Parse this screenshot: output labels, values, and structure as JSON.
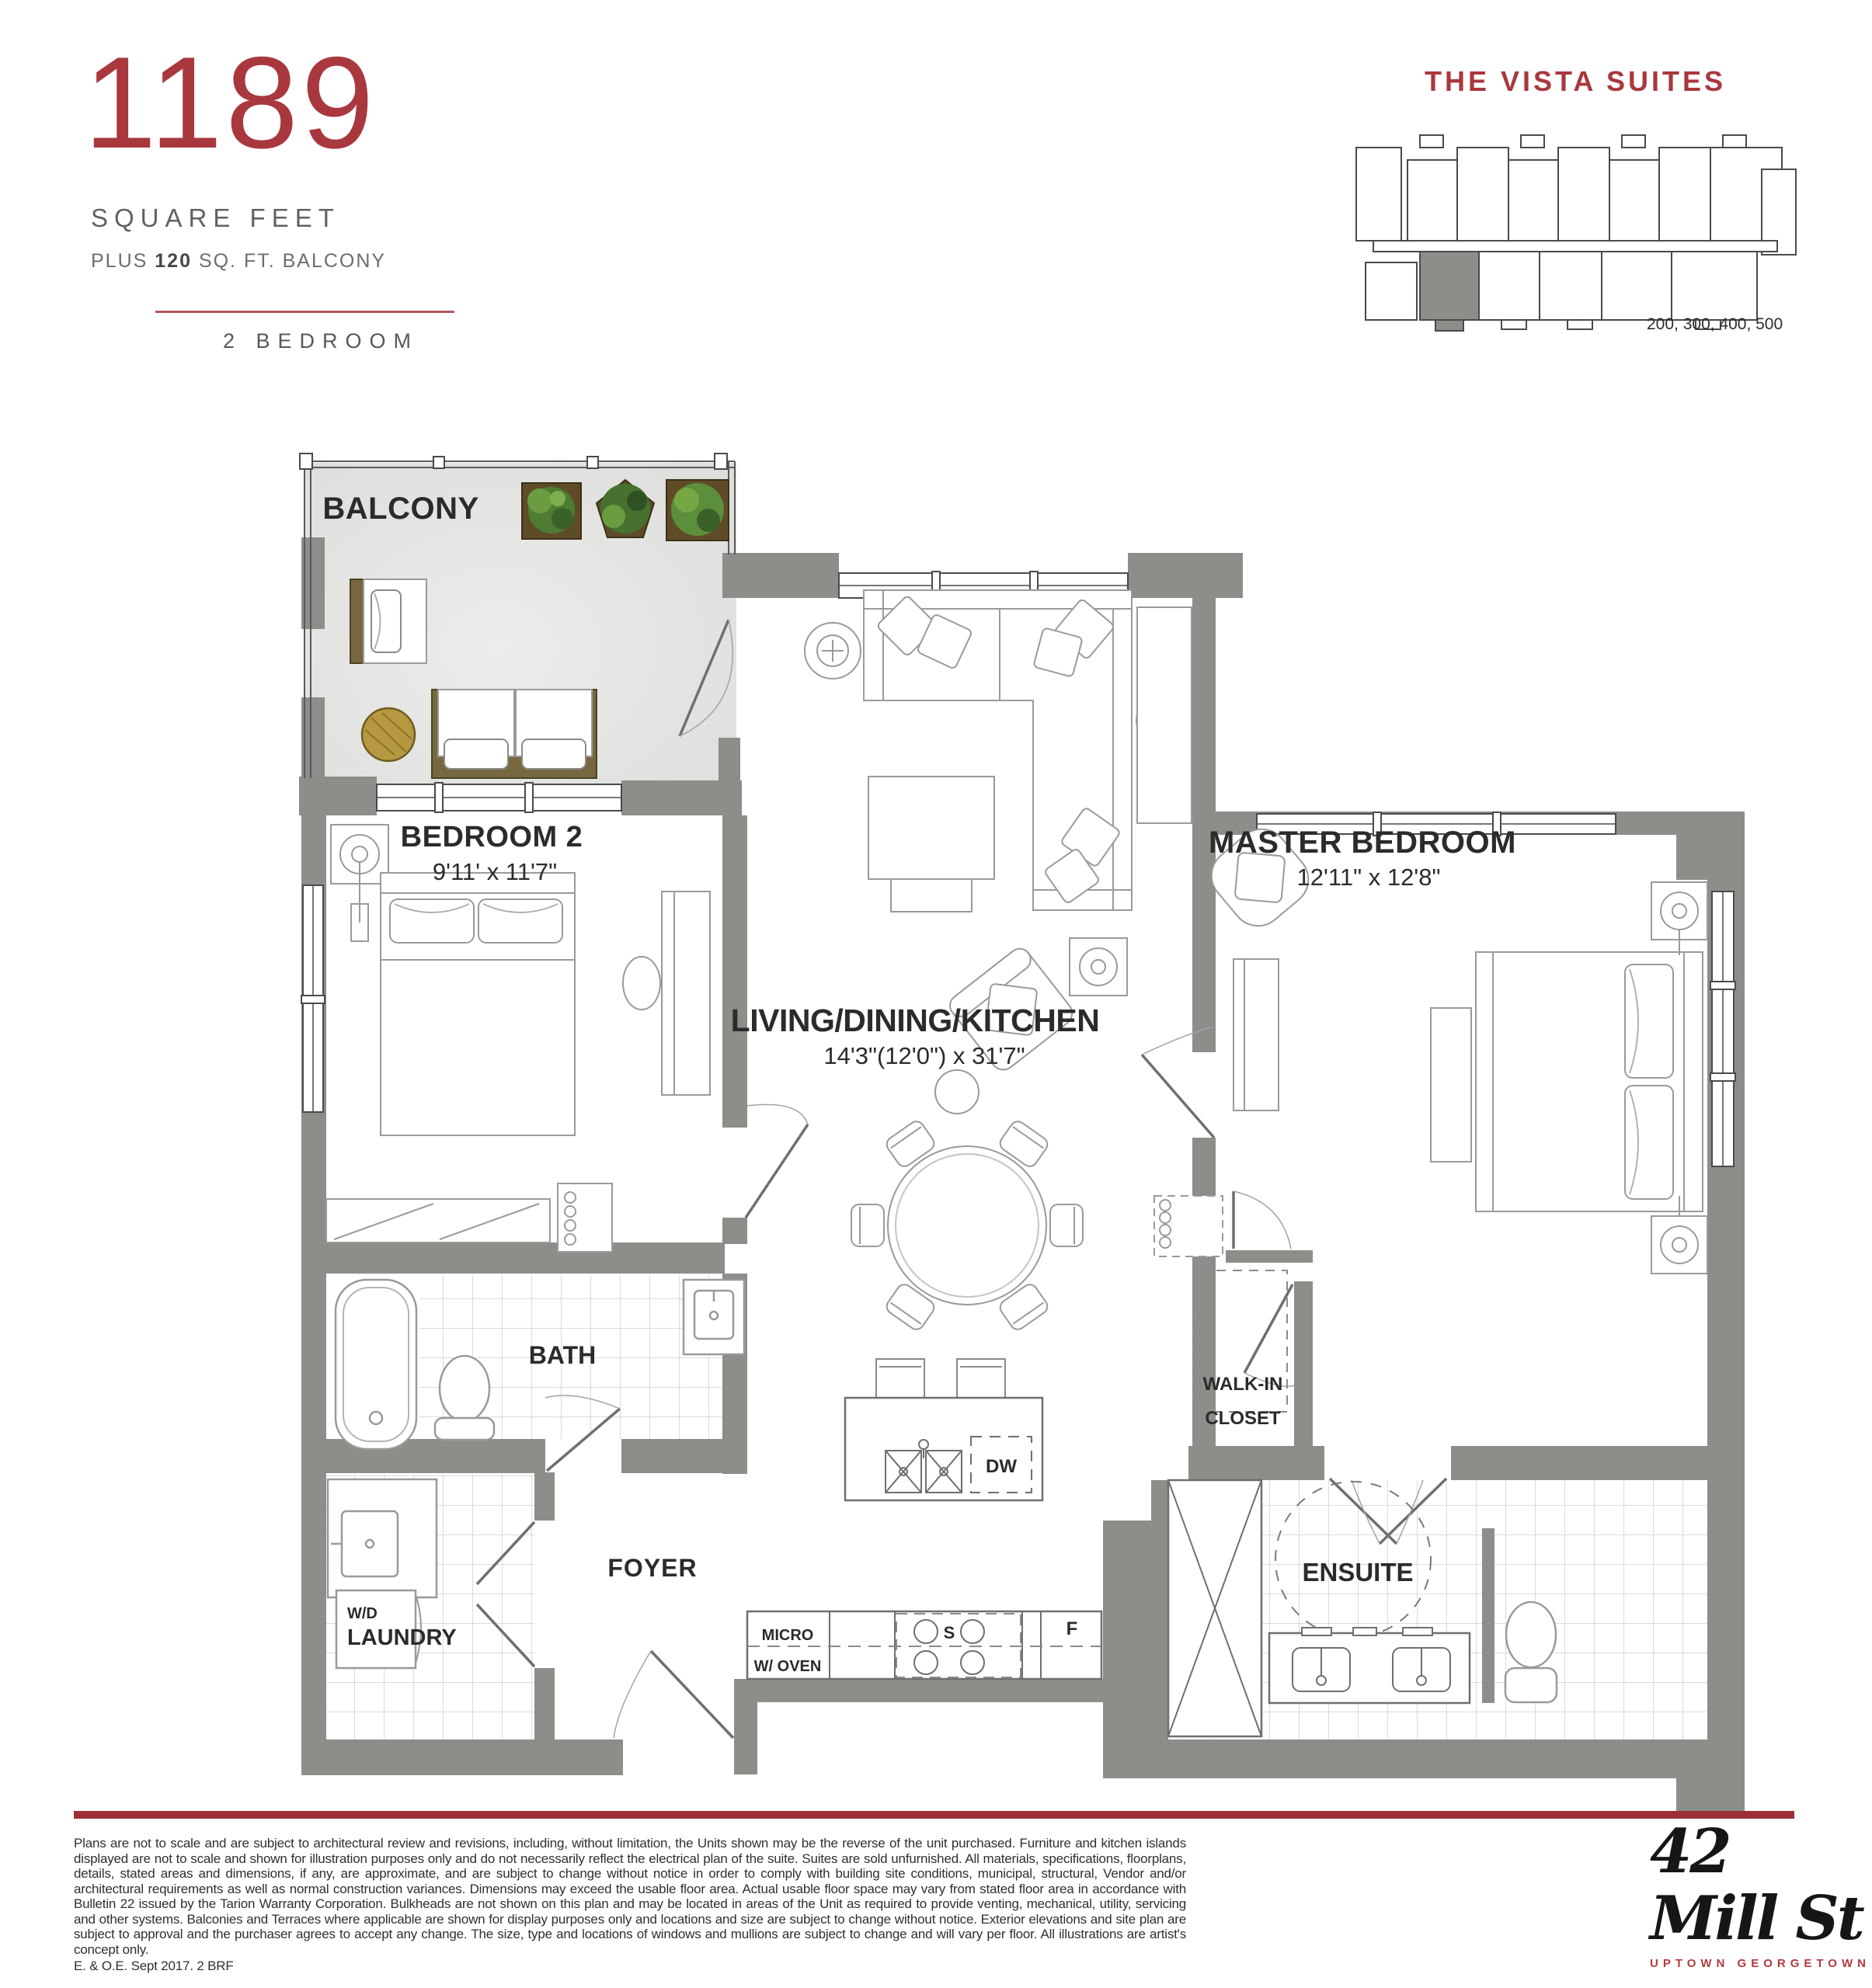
{
  "header": {
    "area_number": "1189",
    "area_label": "SQUARE FEET",
    "balcony_prefix": "PLUS",
    "balcony_bold": "120",
    "balcony_suffix": "SQ. FT. BALCONY",
    "unit_type": "2 BEDROOM"
  },
  "keyplan": {
    "title": "THE VISTA SUITES",
    "levels": "200, 300, 400, 500"
  },
  "plan": {
    "balcony": "BALCONY",
    "bedroom2_name": "BEDROOM 2",
    "bedroom2_dims": "9'11' x 11'7\"",
    "master_name": "MASTER BEDROOM",
    "master_dims": "12'11\" x 12'8\"",
    "living_name": "LIVING/DINING/KITCHEN",
    "living_dims": "14'3\"(12'0\") x 31'7\"",
    "bath": "BATH",
    "walkin_line1": "WALK-IN",
    "walkin_line2": "CLOSET",
    "ensuite": "ENSUITE",
    "foyer": "FOYER",
    "laundry": "LAUNDRY",
    "wd": "W/D",
    "micro_line1": "MICRO",
    "micro_line2": "W/ OVEN",
    "dw": "DW",
    "stove": "S",
    "fridge": "F"
  },
  "footer": {
    "disclaimer": "Plans are not to scale and are subject to architectural review and revisions, including, without limitation, the Units shown may be the reverse of the unit purchased. Furniture and kitchen islands displayed are not to scale and shown for illustration purposes only and do not necessarily reflect the electrical plan of the suite. Suites are sold unfurnished. All materials, specifications, floorplans, details, stated areas and dimensions, if any, are approximate, and are subject to change without notice in order to comply with building site conditions, municipal, structural, Vendor and/or architectural requirements as well as normal construction variances.  Dimensions may exceed the usable floor area. Actual usable floor space may vary from stated floor area in accordance with Bulletin 22 issued by the Tarion Warranty Corporation. Bulkheads are not shown on this plan and may be located in areas of the Unit as required to provide venting, mechanical, utility, servicing and other systems. Balconies and Terraces where applicable are shown for display purposes only and locations and size are subject to change without notice. Exterior elevations and site plan are subject to approval and the purchaser agrees to accept any change. The size, type and locations of windows and mullions are subject to change and will vary per floor. All illustrations are artist's concept only.",
    "eoe": "E. & O.E. Sept 2017. 2 BRF",
    "logo_text": "42 Mill St",
    "logo_sub": "UPTOWN GEORGETOWN"
  },
  "colors": {
    "accent_red": "#a9383e",
    "bar_red": "#9c2f34",
    "wall_gray": "#8b8e89",
    "balcony_floor": "#e2e2de"
  }
}
